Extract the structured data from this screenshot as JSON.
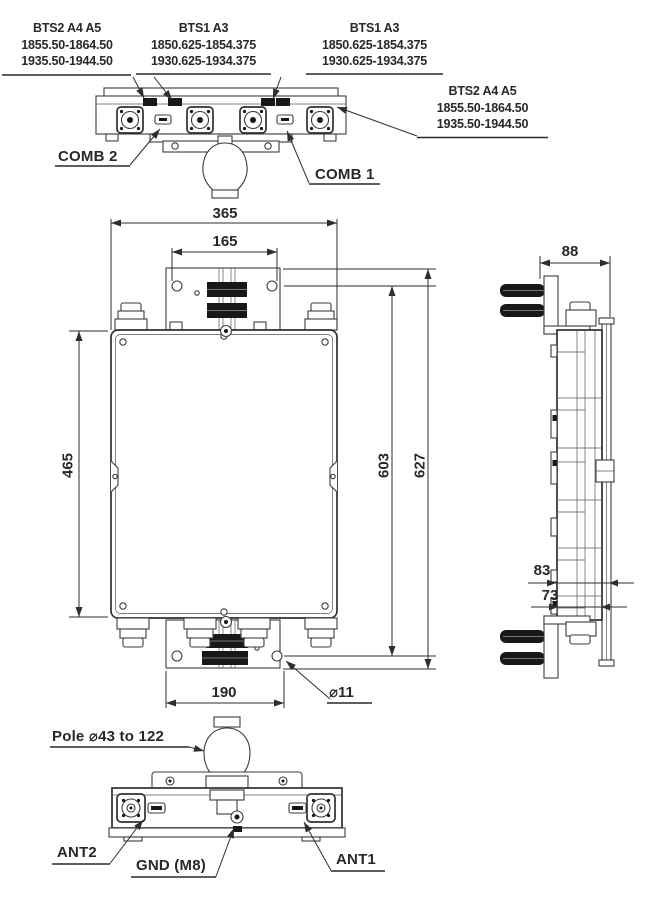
{
  "freq_labels": {
    "top_left": {
      "l1": "BTS2 A4 A5",
      "l2": "1855.50-1864.50",
      "l3": "1935.50-1944.50"
    },
    "top_mid": {
      "l1": "BTS1 A3",
      "l2": "1850.625-1854.375",
      "l3": "1930.625-1934.375"
    },
    "top_right": {
      "l1": "BTS1 A3",
      "l2": "1850.625-1854.375",
      "l3": "1930.625-1934.375"
    },
    "right": {
      "l1": "BTS2 A4 A5",
      "l2": "1855.50-1864.50",
      "l3": "1935.50-1944.50"
    }
  },
  "connector_labels": {
    "comb2": "COMB 2",
    "comb1": "COMB 1",
    "ant2": "ANT2",
    "ant1": "ANT1",
    "gnd": "GND (M8)"
  },
  "notes": {
    "pole_clamp": "Pole ⌀43 to 122"
  },
  "dimensions": {
    "overall_width": "365",
    "top_bracket_hole_spacing": "165",
    "depth": "88",
    "body_height": "465",
    "mounting_hole_span": "603",
    "overall_height": "627",
    "rear_offset": "83",
    "front_offset": "73",
    "bottom_bracket_hole_spacing": "190",
    "mounting_hole_diameter": "⌀11"
  },
  "colors": {
    "line": "#3a3c40",
    "text": "#26282c",
    "fill_black": "#17181a",
    "background": "#ffffff"
  }
}
